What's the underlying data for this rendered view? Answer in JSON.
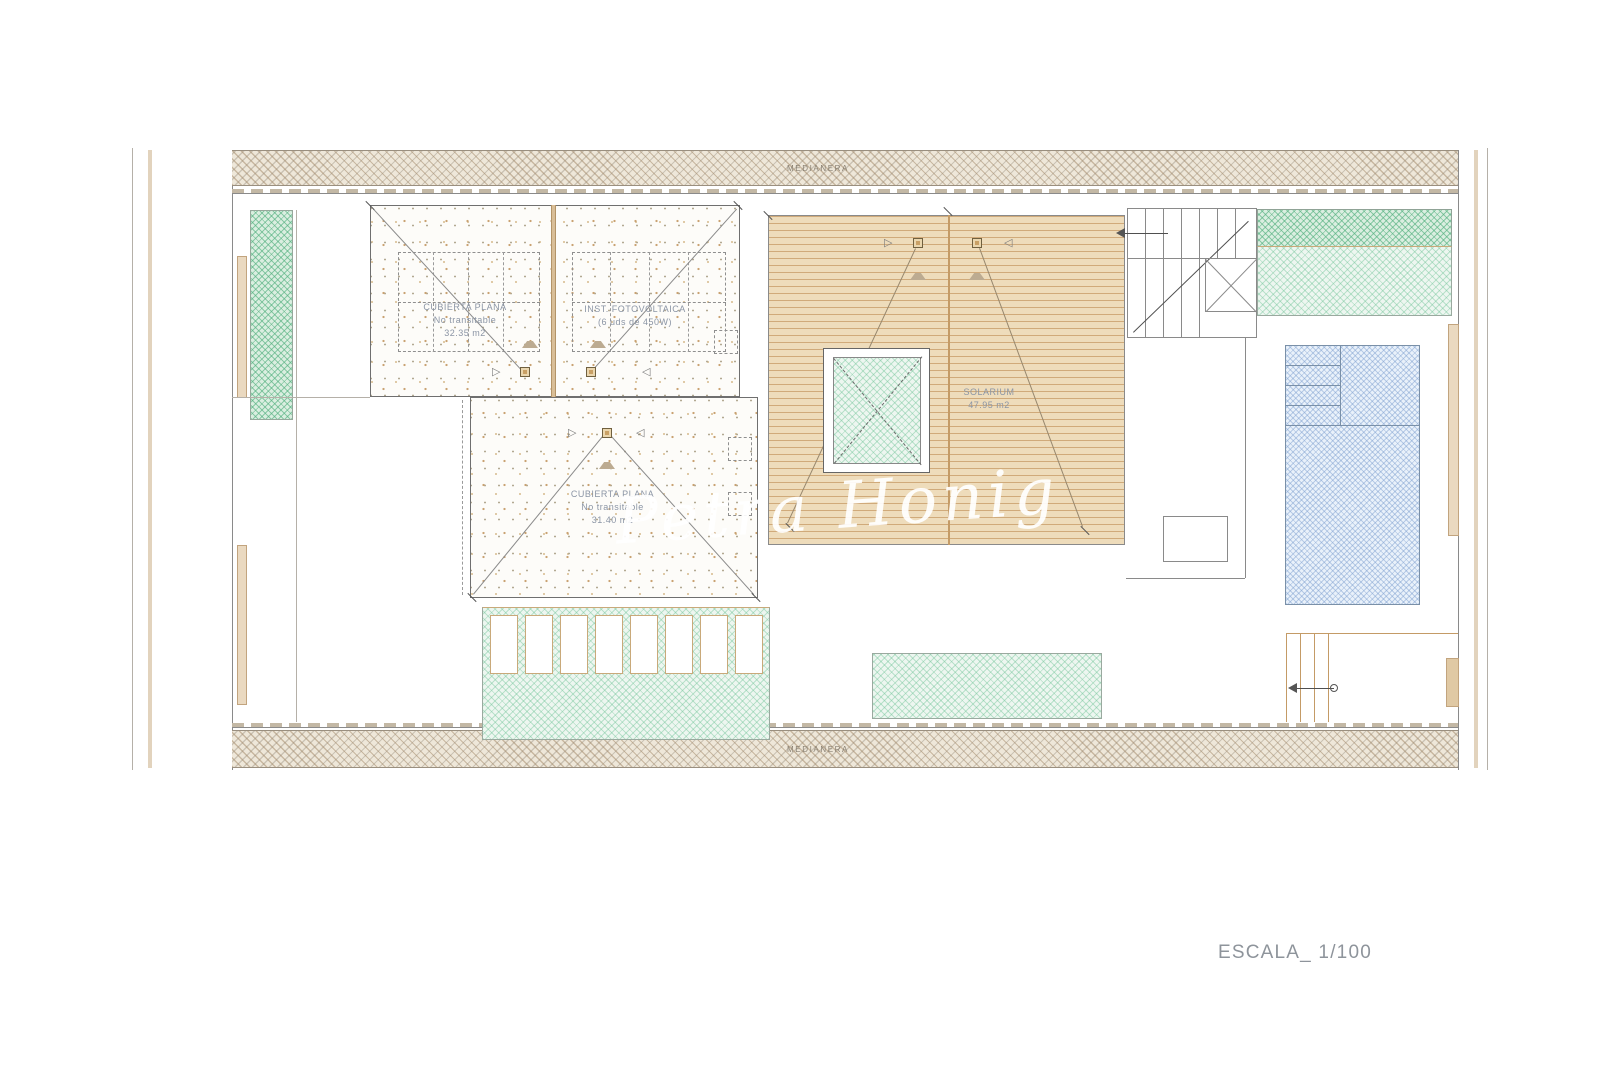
{
  "plan": {
    "party_wall_top": "MEDIANERA",
    "party_wall_bottom": "MEDIANERA",
    "roof_flat_left": {
      "line1": "CUBIERTA PLANA",
      "line2": "No transitable",
      "line3": "32.35 m2"
    },
    "photovoltaic": {
      "line1": "INST. FOTOVOLTAICA",
      "line2": "(6 uds de 450W)"
    },
    "roof_flat_center": {
      "line1": "CUBIERTA PLANA",
      "line2": "No transitable",
      "line3": "31.40 m2"
    },
    "solarium": {
      "line1": "SOLARIUM",
      "line2": "47.95 m2"
    }
  },
  "watermark": "Petra Honig",
  "scale_label": "ESCALA_ 1/100",
  "colors": {
    "deck_tan": "#eedcbb",
    "deck_stripe": "#d0aa7a",
    "green_hatch": "#50af7d",
    "pool_blue": "#7a9bcd",
    "wall_hatch": "#a28868",
    "label_blue_gray": "#8b95a5"
  }
}
